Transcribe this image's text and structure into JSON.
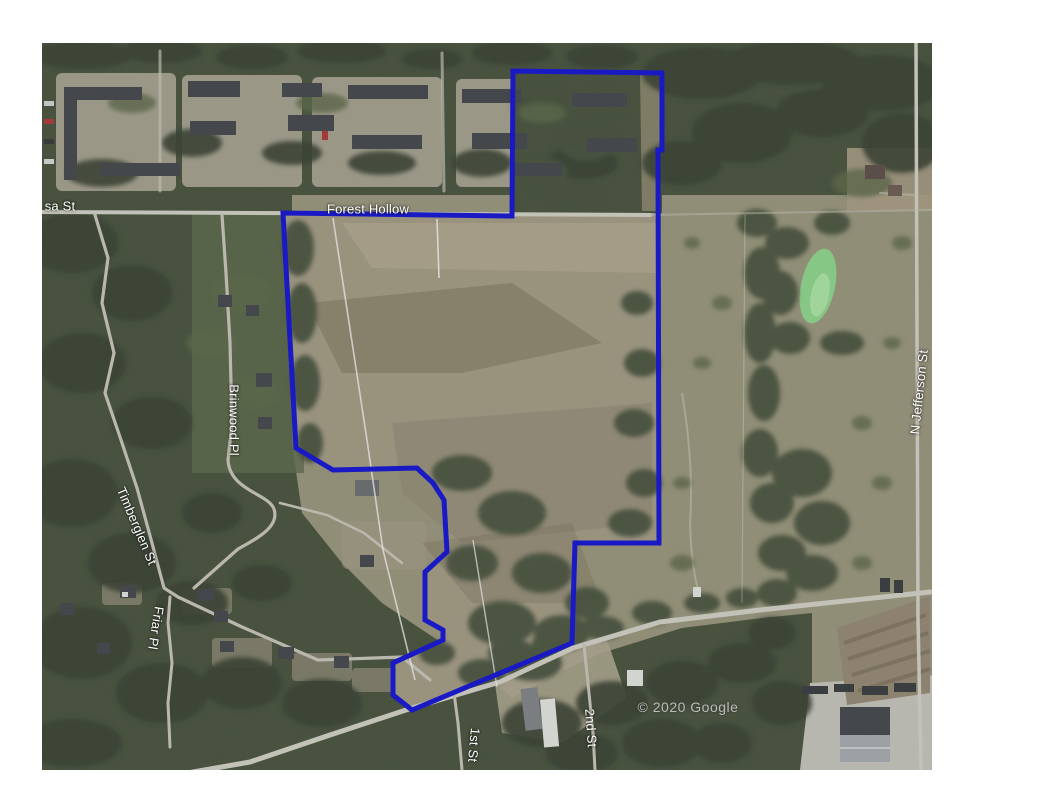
{
  "map": {
    "streets": {
      "mimosa_partial": "sa St",
      "forest_hollow": "Forest Hollow",
      "brinwood": "Brinwood Pl",
      "timberglen": "Timberglen St",
      "friar": "Friar Pl",
      "first_st": "1st St",
      "second_st": "2nd St",
      "n_jefferson": "N Jefferson St"
    },
    "attribution": "© 2020 Google",
    "colors": {
      "boundary": "#0d0dd8",
      "road": "#d7d5ca",
      "road_minor": "#ccc9bd",
      "pasture": "#9a977b",
      "field": "#a59d85",
      "field_light": "#b3aa90",
      "forest": "#44503a",
      "forest_dark": "#333f2c",
      "forest_light": "#5a6847",
      "pond": "#8fdc8d",
      "building_dark": "#3f4347",
      "building_light": "#e9ebe6",
      "survey_line": "#ffffff"
    }
  }
}
